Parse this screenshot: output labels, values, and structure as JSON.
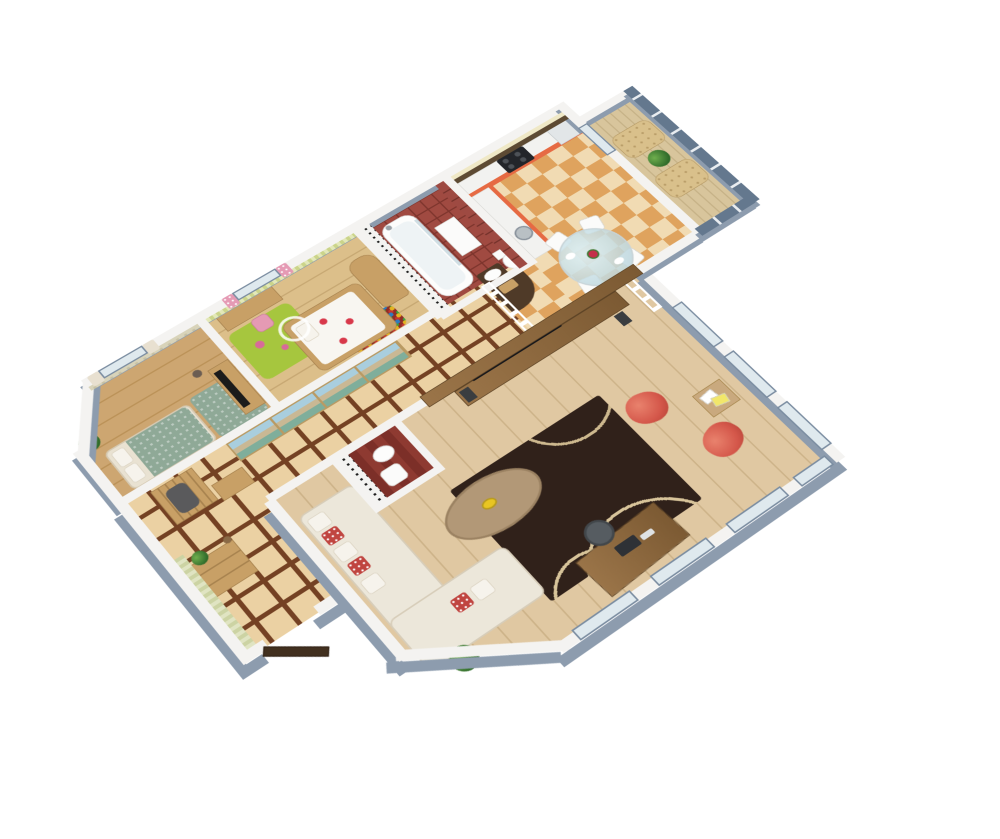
{
  "scene": {
    "type": "3d-apartment-floor-plan-render",
    "view": "isometric-cutaway",
    "background": "#ffffff",
    "palette": {
      "bg": "#ffffff",
      "wall-top": "#f4f3f1",
      "wall-side": "#8d9cae",
      "wood-living": "#e0c8a2",
      "wood-living-line": "#cdb389",
      "hall-tile": "#ebd1a3",
      "hall-grout": "#744123",
      "checker-light": "#f1dbb3",
      "checker-dark": "#dfa35e",
      "bath-floor": "#a04a41",
      "bath-grout": "#7e352d",
      "bath-accent-wall": "#9e4a42",
      "bw-tile-bg": "#f3f3f1",
      "bedroom-floor": "#cda671",
      "kids-floor": "#dcbf8a",
      "balcony-floor": "#d8c59c",
      "kitchen-orange": "#e66a43",
      "backsplash-brown": "#5d4a33",
      "cream-wall": "#efe8c6",
      "green-rug": "#a6c63e",
      "teal-textile": "#8fa997",
      "venice-sky": "#a9cede",
      "venice-building": "#c9b894",
      "venice-water": "#7fae9b",
      "sofa-cream": "#ece7da",
      "pillow-red": "#c04540",
      "rug-dark": "#30211a",
      "rug-line": "#d8c49a",
      "table-wood": "#b29877",
      "chair-coral": "#d4574a",
      "balcony-glass": "#64788e",
      "door-brown": "#42301f",
      "furniture-tan": "#c8a066",
      "glass-blue": "#dfe9ee",
      "office-gray": "#565c61"
    },
    "rooms": [
      {
        "id": "bedroom",
        "name": "master bedroom",
        "floor": "wood planks",
        "wall": "beige circle wallpaper, bay window with cream curtains"
      },
      {
        "id": "kids-room",
        "name": "children's room",
        "floor": "light wood planks",
        "wall": "green striped wallpaper, pink floral curtains"
      },
      {
        "id": "bathroom",
        "name": "bathroom",
        "floor": "dark red tile",
        "wall": "black-white floral tile and dark red tile"
      },
      {
        "id": "kitchen",
        "name": "kitchen",
        "floor": "beige-orange checker tile",
        "wall": "cream with dark brown backsplash"
      },
      {
        "id": "dining",
        "name": "dining corner",
        "floor": "beige-orange checker tile"
      },
      {
        "id": "hallway",
        "name": "entry hallway",
        "floor": "beige tile with brown grid"
      },
      {
        "id": "powder-room",
        "name": "powder room",
        "floor": "dark red wood",
        "wall": "black-white floral wallpaper"
      },
      {
        "id": "living-room",
        "name": "living room",
        "floor": "light wood planks"
      },
      {
        "id": "balcony",
        "name": "glazed balcony",
        "floor": "light wood strips",
        "glazing": "blue-gray panels"
      }
    ],
    "furniture": {
      "bedroom": [
        "double bed with cream linens",
        "teal patterned rug",
        "tv on wooden stand",
        "potted plant",
        "floor lamp",
        "window with cream curtains"
      ],
      "kids_room": [
        "canopy bed with flower blanket",
        "colorful ball-pit rug",
        "arched wardrobe",
        "writing desk",
        "desk chair",
        "green play rug",
        "window with pink curtains"
      ],
      "bathroom": [
        "bathtub with glass screen",
        "shower head",
        "tall white cabinet",
        "toilet",
        "vanity sink on dark cabinet"
      ],
      "kitchen": [
        "orange upper cabinets",
        "extractor hood",
        "stove with oven",
        "orange base cabinets with white counter",
        "round steel sink",
        "fridge cabinet",
        "dark wood bar with snack board"
      ],
      "dining": [
        "round glass dining table",
        "vase with red flowers",
        "plates with food",
        "four white chairs"
      ],
      "hallway": [
        "sliding wardrobe with venice canal print",
        "coat rack with coat",
        "shoe bench",
        "chest of drawers",
        "potted plant",
        "open entry door"
      ],
      "powder_room": [
        "white wall sink",
        "white chair"
      ],
      "living_room": [
        "white corner sofa with red pillows",
        "oval coffee table with fruit bowl",
        "dark patterned rug",
        "tv on long media console",
        "two speakers",
        "two coral egg chairs",
        "magazine side table",
        "computer desk with monitor",
        "gray office chair",
        "potted plant",
        "panoramic windows"
      ],
      "balcony": [
        "two tufted beige lounge chairs",
        "potted plant"
      ]
    }
  }
}
